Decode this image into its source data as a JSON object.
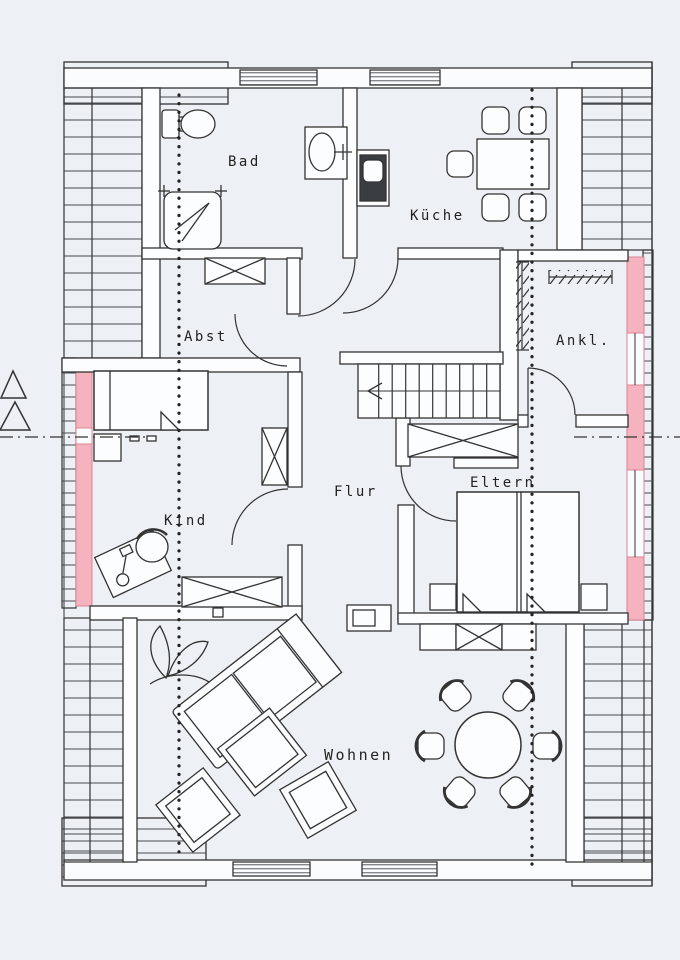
{
  "plan": {
    "rooms": {
      "bad": {
        "label": "Bad"
      },
      "kueche": {
        "label": "Küche"
      },
      "abst": {
        "label": "Abst"
      },
      "ankl": {
        "label": "Ankl."
      },
      "kind": {
        "label": "Kind"
      },
      "flur": {
        "label": "Flur"
      },
      "eltern": {
        "label": "Eltern"
      },
      "wohnen": {
        "label": "Wohnen"
      }
    },
    "colors": {
      "paper": "#edf0f5",
      "ink": "#333333",
      "knee_wall_highlight": "#f4b3bf",
      "knee_wall_highlight_edge": "#dd8494"
    }
  }
}
